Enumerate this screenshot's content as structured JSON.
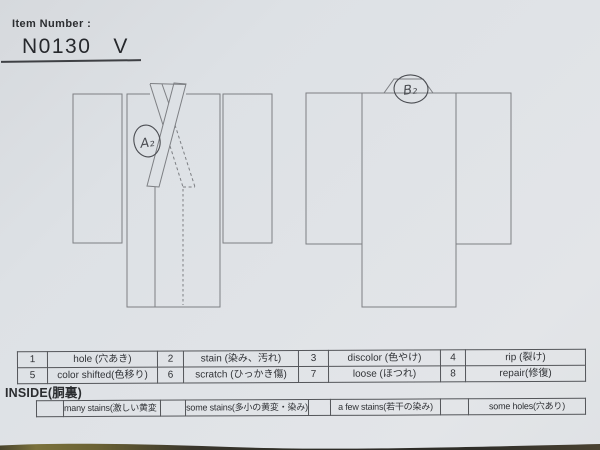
{
  "header": {
    "label": "Item Number :",
    "item_number": "N0130   V"
  },
  "diagrams": {
    "front_annotation": "A₂",
    "back_annotation": "B₂"
  },
  "condition_table": {
    "rows": [
      [
        "1",
        "hole (穴あき)",
        "2",
        "stain (染み、汚れ)",
        "3",
        "discolor (色やけ)",
        "4",
        "rip (裂け)"
      ],
      [
        "5",
        "color shifted(色移り)",
        "6",
        "scratch (ひっかき傷)",
        "7",
        "loose (ほつれ)",
        "8",
        "repair(修復)"
      ]
    ]
  },
  "inside": {
    "label": "INSIDE(胴裏)",
    "cells": [
      "",
      "many stains(激しい黄変・染み)",
      "",
      "some stains(多小の黄変・染み)",
      "",
      "a few stains(若干の染み)",
      "",
      "some holes(穴あり)"
    ]
  },
  "colors": {
    "paper": "#dde1e5",
    "outline": "#7d7f83",
    "table_border": "#54565a",
    "text": "#2e3033",
    "handwriting_ink": "#4b4d52"
  }
}
